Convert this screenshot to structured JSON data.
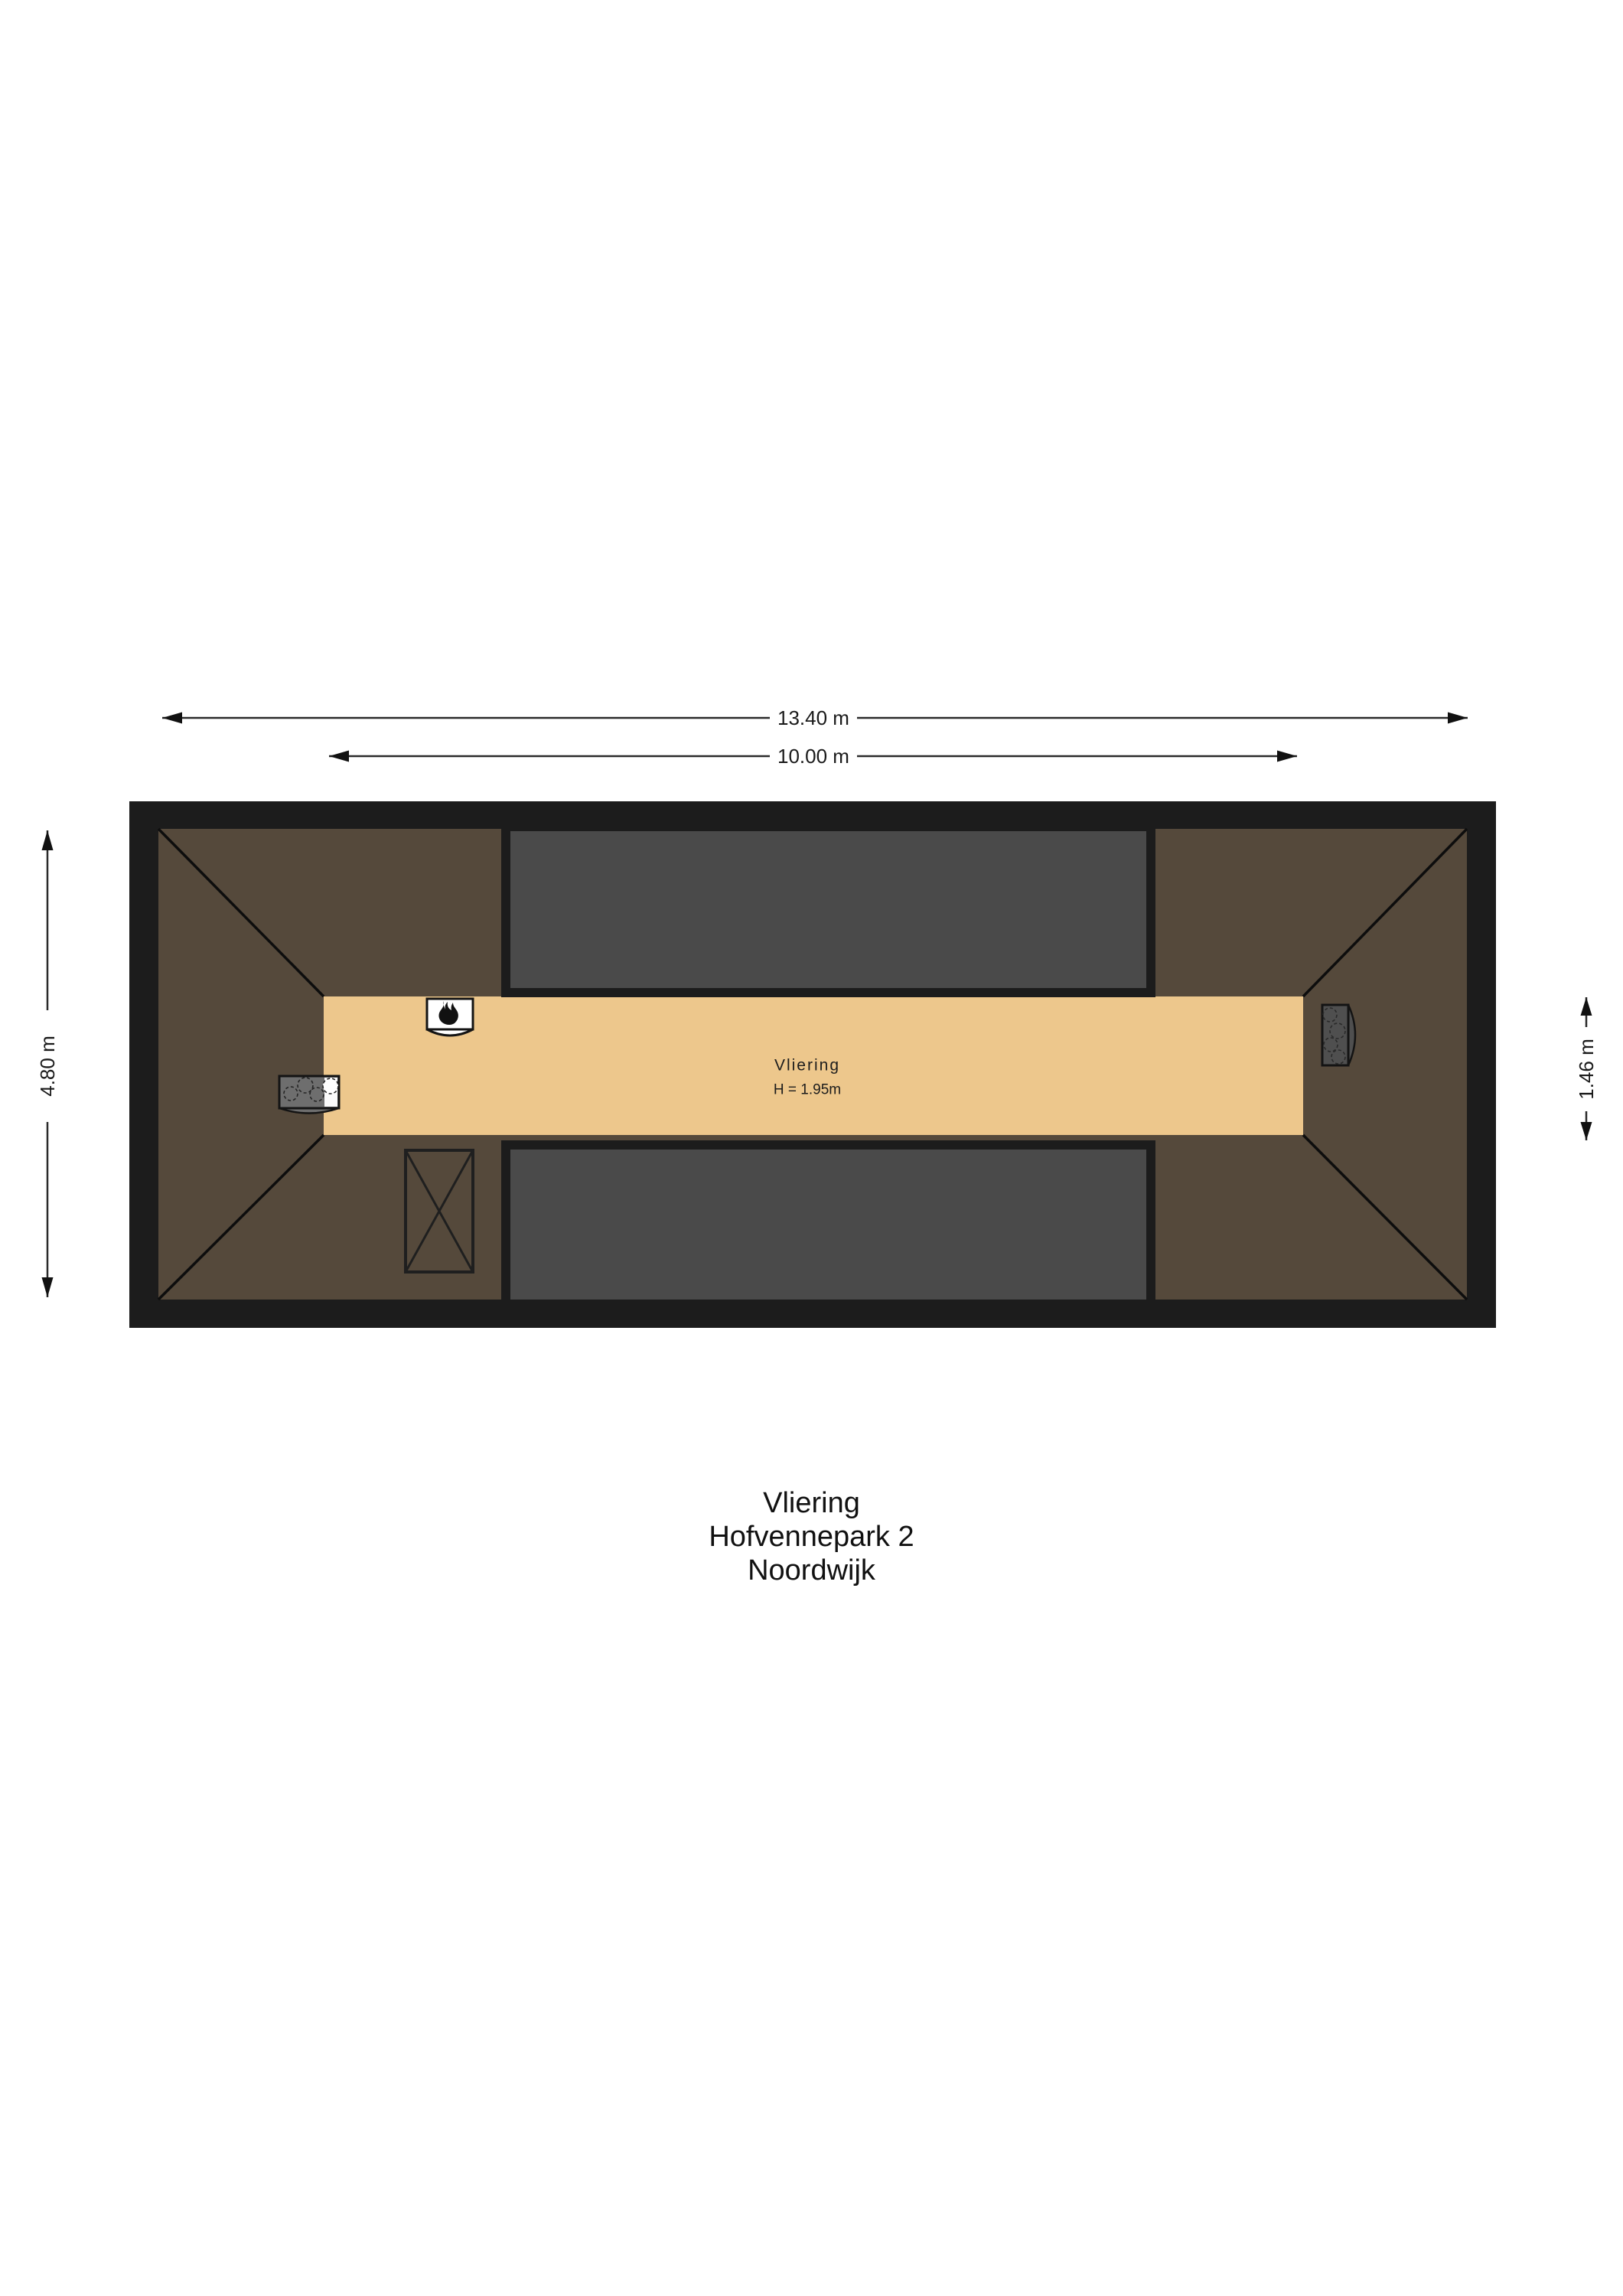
{
  "plan": {
    "room_label": "Vliering",
    "room_height_label": "H = 1.95m"
  },
  "dimensions": {
    "outer_width": "13.40 m",
    "floor_length": "10.00 m",
    "outer_depth": "4.80 m",
    "floor_width": "1.46 m"
  },
  "title_block": {
    "line1": "Vliering",
    "line2": "Hofvennepark 2",
    "line3": "Noordwijk"
  },
  "icons": {
    "boiler": "flame-icon",
    "left_appliance": "burner-circles-icon",
    "right_appliance": "burner-circles-icon",
    "shaft": "crossed-box-icon"
  },
  "colors": {
    "background": "#ffffff",
    "wall_black": "#1c1c1c",
    "roof_brown": "#55493b",
    "floor_tan": "#edc78c",
    "dormer_gray": "#4a4a4a",
    "line_black": "#0d0d0d"
  }
}
